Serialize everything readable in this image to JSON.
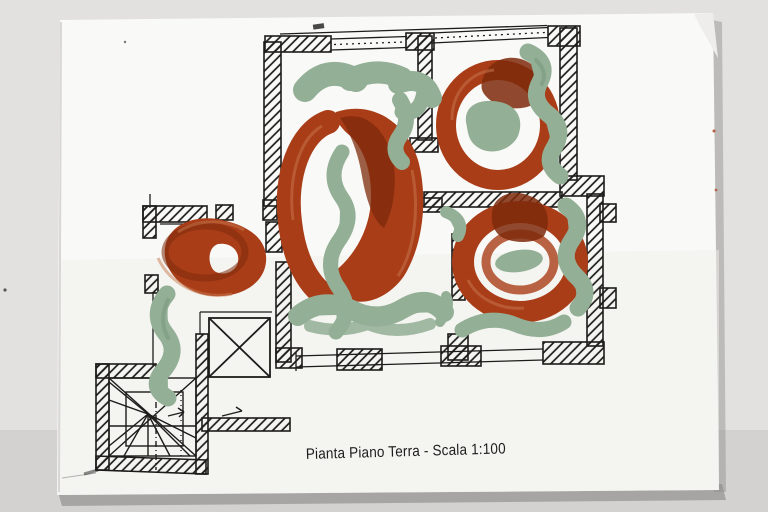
{
  "caption": {
    "text": "Pianta Piano Terra - Scala 1:100"
  },
  "colors": {
    "background": "#e2e1df",
    "background_dark": "#c8c7c5",
    "paper": "#f9f9f7",
    "paper_shade": "#efefec",
    "shadow": "#8e8d8b",
    "ink": "#1d1c1a",
    "paint_red": "#a93d18",
    "paint_red_dark": "#7e2a0b",
    "paint_red_light": "#c8794f",
    "paint_green": "#93af95",
    "paint_green_dark": "#75977c"
  }
}
